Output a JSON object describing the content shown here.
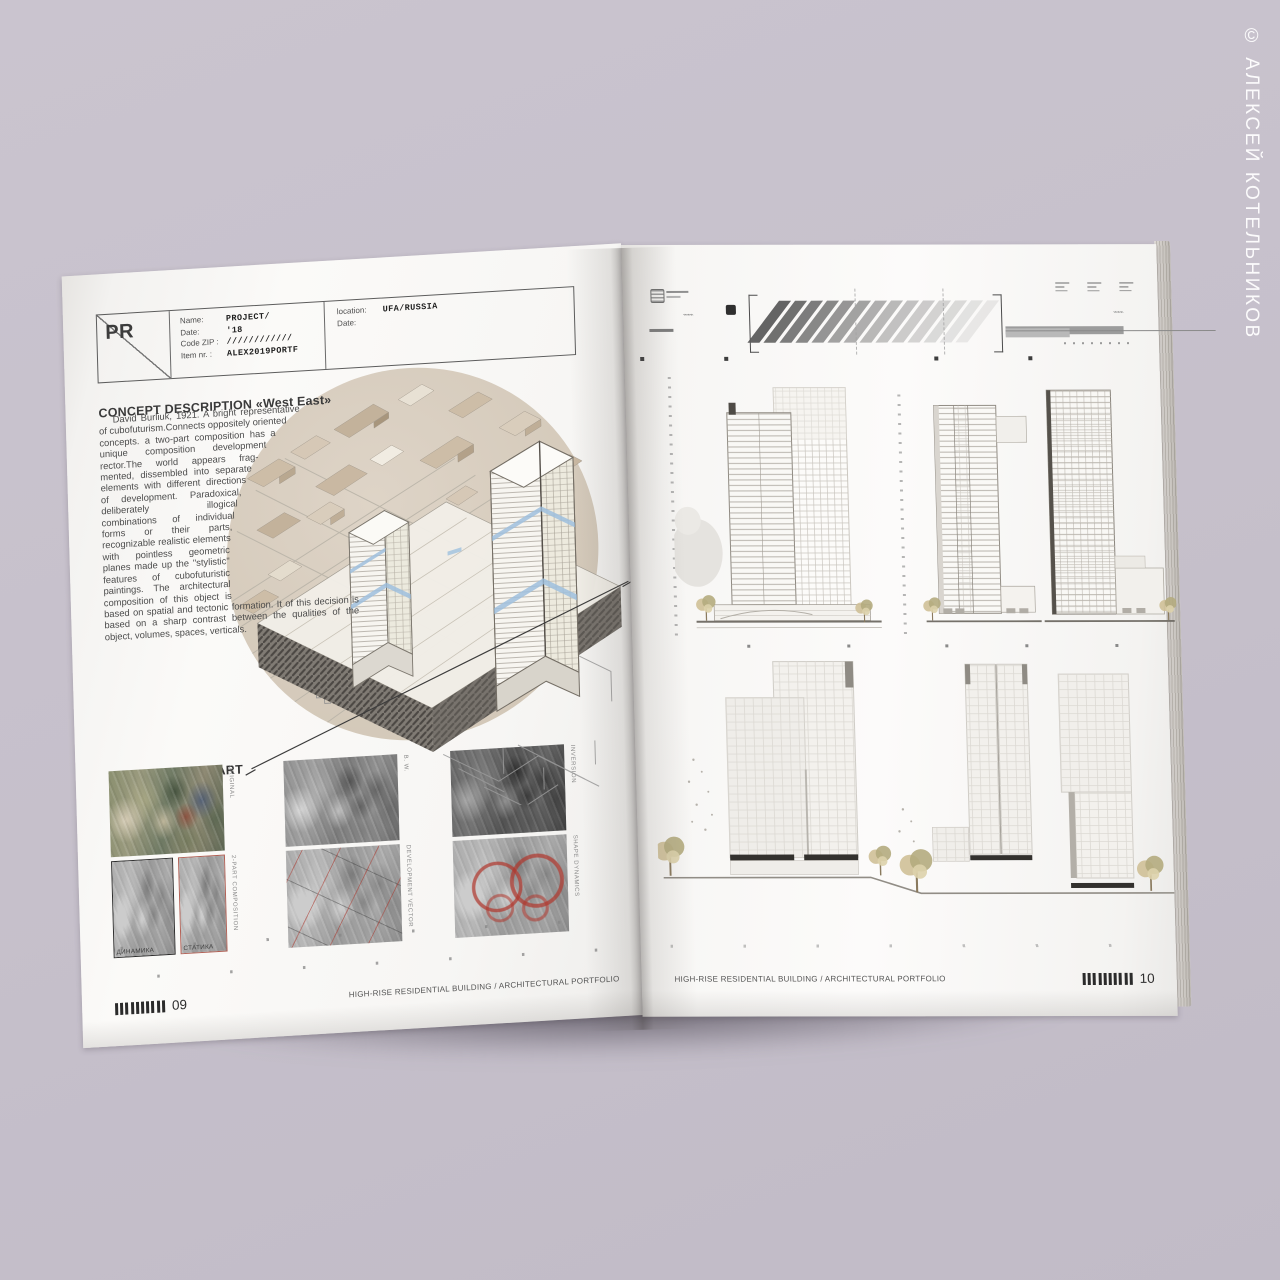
{
  "copyright": "© АЛЕКСЕЙ КОТЕЛЬНИКОВ",
  "book": {
    "left_page": {
      "header_box": {
        "code": "PR",
        "fields": [
          {
            "label": "Name:",
            "value": "PROJECT/"
          },
          {
            "label": "Date:",
            "value": "'18"
          },
          {
            "label": "Code ZIP :",
            "value": "////////////"
          },
          {
            "label": "Item nr. :",
            "value": "ALEX2019PORTF"
          }
        ],
        "location_fields": [
          {
            "label": "location:",
            "value": "UFA/RUSSIA"
          },
          {
            "label": "Date:",
            "value": ""
          }
        ]
      },
      "concept_title": "CONCEPT DESCRIPTION «West East»",
      "concept_body": "David Burliuk, 1921. A bright representative of cubofuturism.Connects oppositely oriented concepts. a two-part composition has a unique composition development rector.The world appears frag-mented, dissembled into separate elements with different directions of development. Paradoxical, deliberately illogical combinations of individual forms or their parts, recognizable realistic elements with pointless geometric planes made up the \"stylistic\" features of cubofuturistic paintings. The architectural composition of this object is based on spatial and tectonic formation. It of this decision is based on a sharp contrast between the qualities of the object, volumes, spaces, verticals.",
      "grafical_title": "THE GRAFICAL PART",
      "thumb_captions": [
        "ORIGINAL",
        "B. W.",
        "INVERSION",
        "2-PART COMPOSITION",
        "DEVELOPMENT VECTOR",
        "SHAPE DYNAMICS"
      ],
      "dynamics_label": "ДИНАМИКА",
      "statics_label": "СТАТИКА",
      "footer_page": "09",
      "footer_title": "HIGH-RISE RESIDENTIAL BUILDING / ARCHITECTURAL PORTFOLIO"
    },
    "right_page": {
      "footer_title": "HIGH-RISE RESIDENTIAL BUILDING / ARCHITECTURAL PORTFOLIO",
      "footer_page": "10"
    }
  },
  "colors": {
    "background": "#c6c0cb",
    "page": "#f8f7f5",
    "accent_blue": "#a5c3e0",
    "accent_red": "#b2564a",
    "map_beige": "#d8cec1"
  }
}
